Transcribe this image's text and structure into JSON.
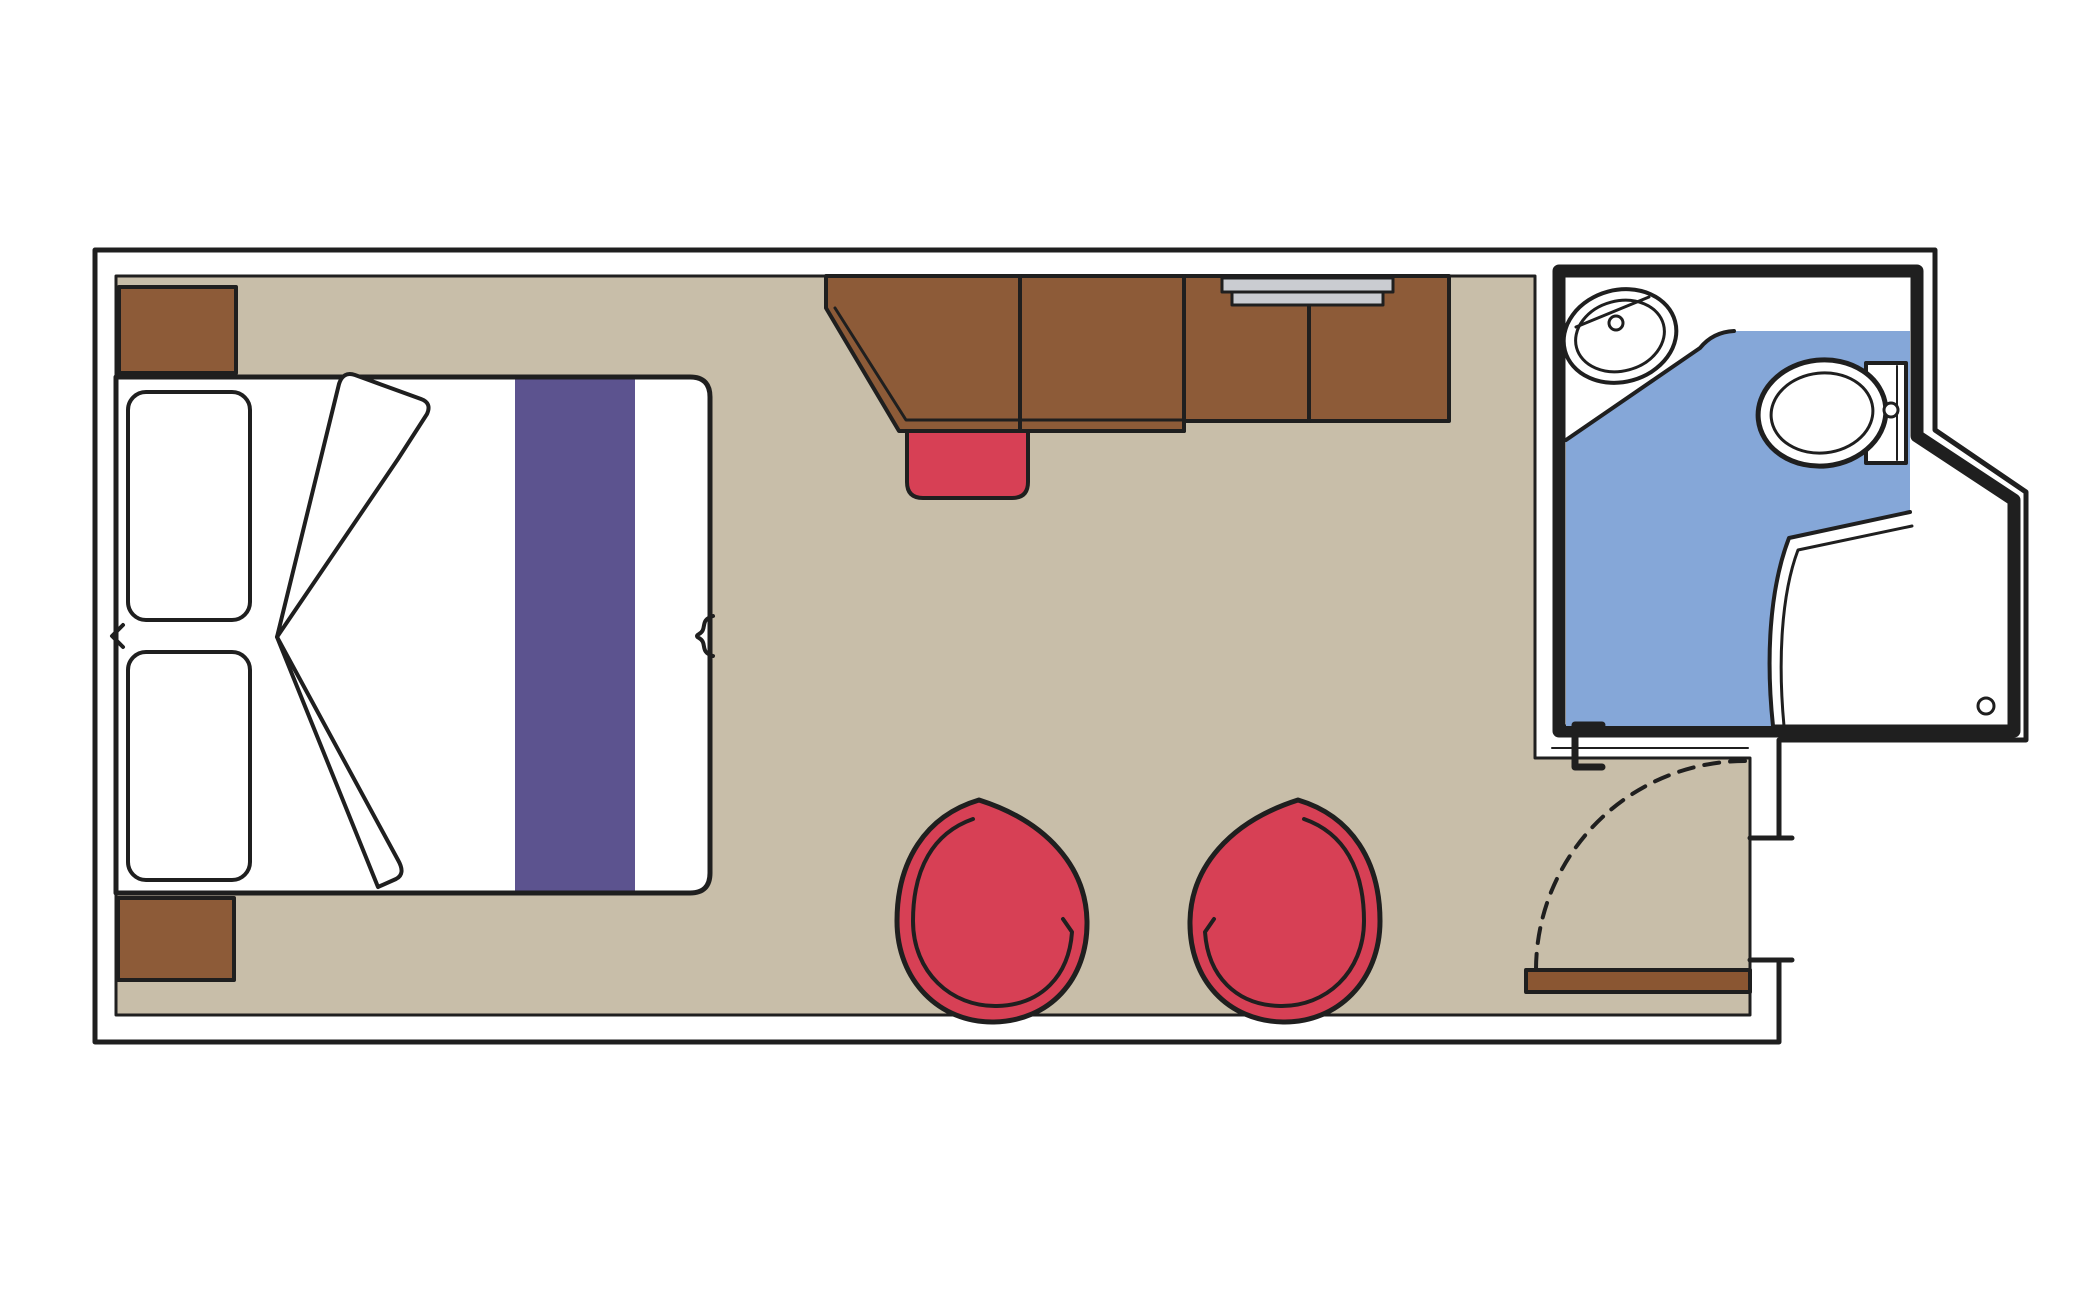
{
  "diagram": {
    "type": "floor-plan",
    "description_names": [
      "outer-wall",
      "cabin-floor",
      "double-bed",
      "pillow-left",
      "pillow-right",
      "duvet-fold",
      "bed-runner",
      "mattress-split-notch",
      "bed-edge-bracket",
      "nightstand-top",
      "nightstand-bottom",
      "desk-cabinet-unit",
      "desk-divider",
      "wall-shelf",
      "vanity-stool",
      "tub-chair-left",
      "tub-chair-right",
      "bathroom",
      "bathroom-floor",
      "sink",
      "sink-drain",
      "toilet",
      "toilet-tank",
      "flush-button",
      "shower",
      "shower-drain",
      "sliding-door-track",
      "sliding-door-handle",
      "entry-doorway",
      "entry-door-leaf",
      "door-swing-arc"
    ]
  },
  "colors": {
    "background": "#ffffff",
    "outline": "#1f1f1f",
    "wall_fill": "#ffffff",
    "floor_tan": "#c8bea9",
    "furniture_brown": "#8d5b38",
    "door_brown": "#8a5632",
    "accent_red": "#d74055",
    "runner_purple": "#5c538f",
    "bathroom_blue": "#85a7d8",
    "fixture_white": "#ffffff",
    "shelf_gray": "#caccd1"
  }
}
